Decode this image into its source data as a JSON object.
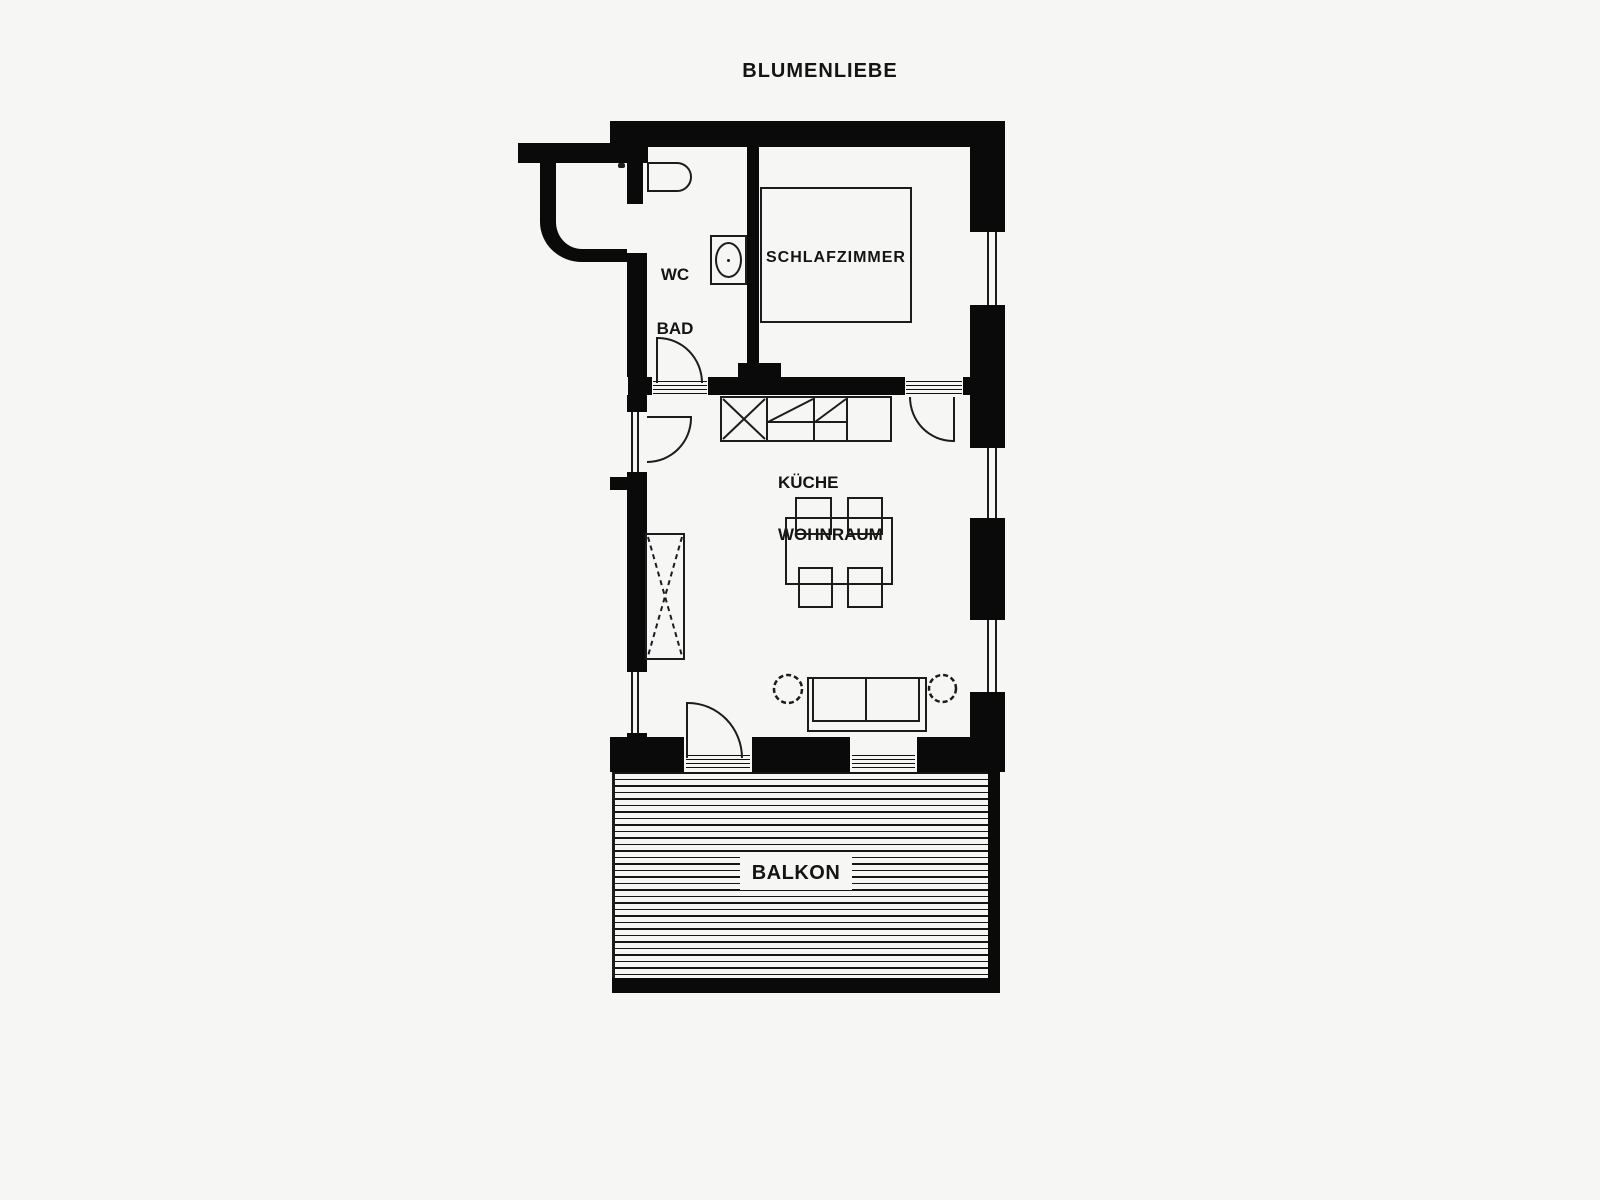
{
  "title": "BLUMENLIEBE",
  "colors": {
    "background": "#f6f6f5",
    "wall": "#0a0a0a",
    "line": "#1c1c1c"
  },
  "rooms": {
    "bathroom": {
      "line1": "WC",
      "line2": "BAD"
    },
    "bedroom": {
      "label": "SCHLAFZIMMER"
    },
    "living": {
      "line1": "KÜCHE",
      "line2": "WOHNRAUM"
    },
    "balcony": {
      "label": "BALKON"
    }
  }
}
